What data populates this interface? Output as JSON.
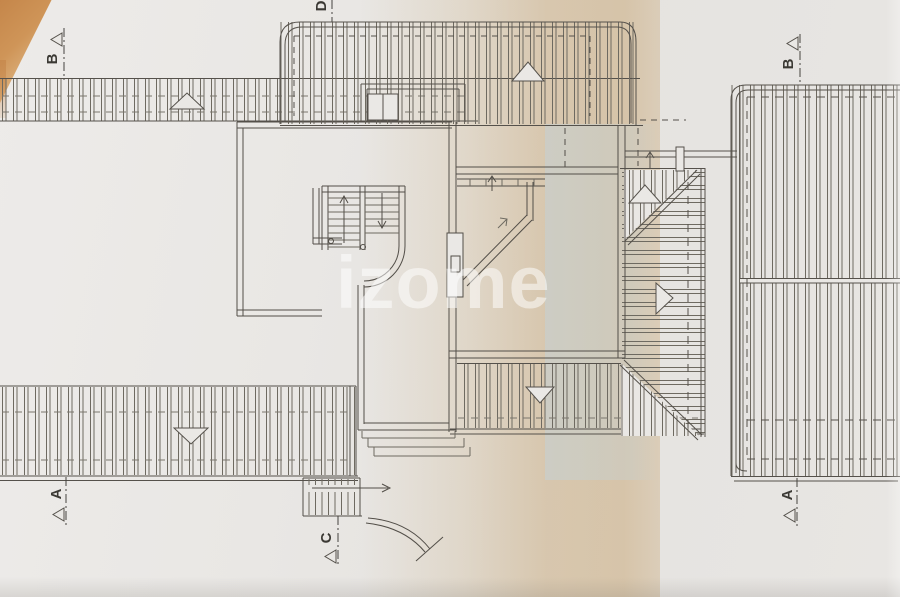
{
  "drawing": {
    "watermark": "izome",
    "section_markers": [
      {
        "id": "b-left",
        "label": "B"
      },
      {
        "id": "d-top",
        "label": "D"
      },
      {
        "id": "b-right",
        "label": "B"
      },
      {
        "id": "a-left",
        "label": "A"
      },
      {
        "id": "a-right",
        "label": "A"
      },
      {
        "id": "c-bottom",
        "label": "C"
      }
    ],
    "colors": {
      "paper": "#e7e5e2",
      "tan_band": "#c1985c",
      "cool_band": "#c4d2d6",
      "corner_wedge": "#cf9558",
      "ink": "#55514b",
      "watermark": "#ffffff"
    }
  }
}
